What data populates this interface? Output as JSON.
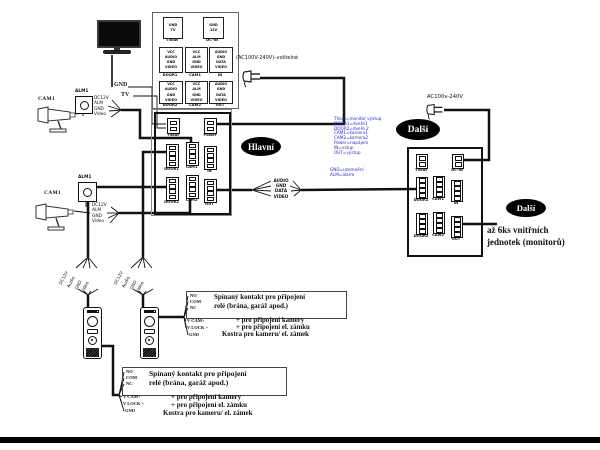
{
  "page": {
    "background": "#ffffff",
    "line_color": "#111111",
    "blue_text_color": "#2b2bc8"
  },
  "monitor": {
    "gnd": "GND",
    "tv": "TV"
  },
  "camera1": {
    "name": "CAM1",
    "alarm": "ALM1",
    "wires": [
      "DC12V",
      "ALM",
      "GND",
      "Video"
    ]
  },
  "camera2": {
    "name": "CAM1",
    "alarm": "ALM1",
    "wires": [
      "DC12V",
      "ALM",
      "GND",
      "Video"
    ]
  },
  "legend_panel": {
    "boxes": [
      {
        "pins": [
          "GND",
          "TV"
        ],
        "label": "TVout"
      },
      {
        "pins": [
          "GND",
          "12V"
        ],
        "label": "DC-IN"
      },
      {
        "pins": [
          "VCC",
          "AUDIO",
          "GND",
          "VIDEO"
        ],
        "label": "DOOR1"
      },
      {
        "pins": [
          "VCC",
          "ALM",
          "GND",
          "VIDEO"
        ],
        "label": "CAM1"
      },
      {
        "pins": [
          "AUDIO",
          "GND",
          "DATA",
          "VIDEO"
        ],
        "label": "IN"
      },
      {
        "pins": [
          "VCC",
          "AUDIO",
          "GND",
          "VIDEO"
        ],
        "label": "DOOR2"
      },
      {
        "pins": [
          "VCC",
          "ALM",
          "GND",
          "VIDEO"
        ],
        "label": "CAM2"
      },
      {
        "pins": [
          "AUDIO",
          "GND",
          "DATA",
          "VIDEO"
        ],
        "label": "OUT"
      }
    ]
  },
  "main_unit": {
    "connectors": [
      "TVout",
      "Power",
      "DOOR1",
      "CAM1",
      "IN",
      "DOOR2",
      "CAM2",
      "OUT"
    ]
  },
  "unit2": {
    "connectors": [
      "TVout",
      "DC-IN",
      "DOOR1",
      "CAM1",
      "IN",
      "DOOR2",
      "CAM2",
      "OUT"
    ]
  },
  "badges": {
    "main": "Hlavní",
    "next1": "Další",
    "next2": "Další"
  },
  "power_top": {
    "label": "(AC100V-240V)–volitelné"
  },
  "power_right": {
    "label": "AC100v-240V"
  },
  "bus": {
    "labels": [
      "AUDIO",
      "GND",
      "DATA",
      "VIDEO"
    ]
  },
  "blue_legend": {
    "lines": [
      "TVout=monitor výstup",
      "DOOR1=dveře1",
      "DOOR2=dveře 2",
      "CAM1=kamera1",
      "CAM2=kamera2",
      "Power=napájení",
      "IN=vstup",
      "OUT=výstup"
    ],
    "lines2": [
      "GND=uzemnění",
      "ALM=alarm"
    ]
  },
  "expansion": {
    "note_line1": "až 6ks vnitřních",
    "note_line2": "jednotek (monitorů)"
  },
  "stations": {
    "wires": [
      "DC12V",
      "Audio",
      "GND",
      "Video"
    ]
  },
  "relay_note": {
    "terminals": [
      "NO",
      "COM",
      "NC",
      "V CAM+",
      "V LOCK +",
      "GND"
    ],
    "box_line1": "Spínaný kontakt pro připojení",
    "box_line2": "relé (brána, garáž apod.)",
    "cam_line": "+ pro připojení kamery",
    "lock_line": "+ pro připojení el. zámku",
    "ground_line": "Kostra pro kameru/ el. zámek"
  }
}
